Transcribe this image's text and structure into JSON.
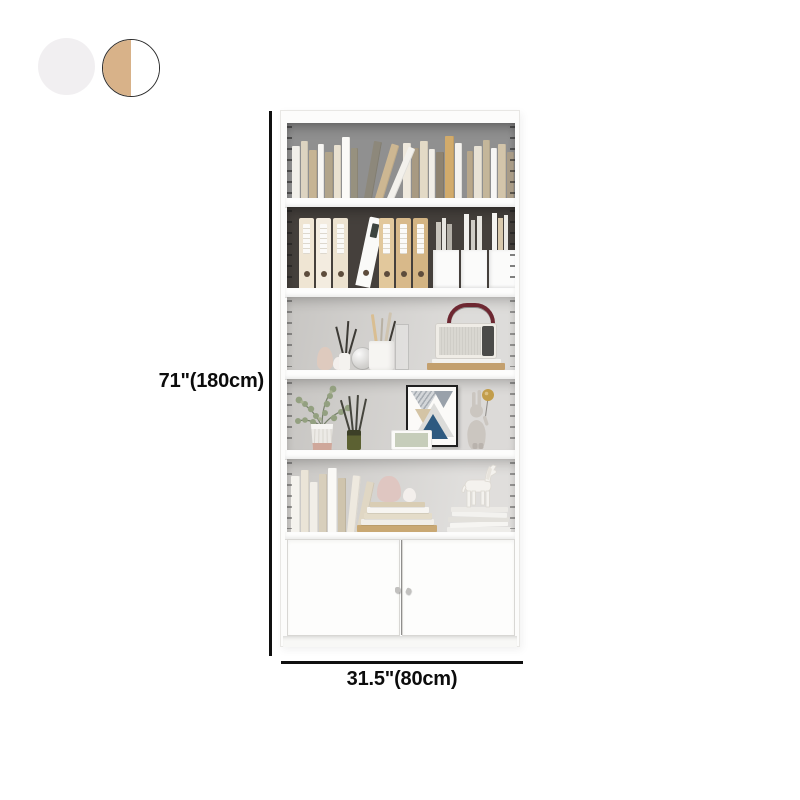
{
  "product": {
    "type": "bookcase-with-cabinet-product-image"
  },
  "dimensions": {
    "height_label": "71\"(180cm)",
    "width_label": "31.5\"(80cm)"
  },
  "swatches": [
    {
      "id": "white",
      "color": "#f1eff1",
      "selected": false
    },
    {
      "id": "white-and-wood",
      "color_left": "#d8b289",
      "color_right": "#ffffff",
      "selected": true
    }
  ],
  "colors": {
    "dimension_line": "#101010",
    "case_white": "#fcfcfb",
    "shelf_back_gray": "#909090",
    "shelf_back_dark": "#45403c",
    "shelf_back_light": "#d2d0cd",
    "wood_accent": "#d8b586"
  }
}
